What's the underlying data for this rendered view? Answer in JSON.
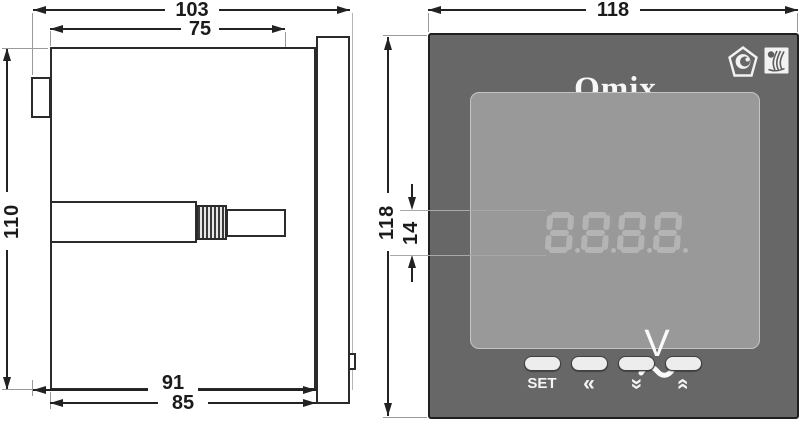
{
  "side_view": {
    "dims": {
      "overall_depth": "103",
      "case_depth": "75",
      "overall_height": "110",
      "depth_behind_panel": "91",
      "case_body_depth": "85"
    }
  },
  "front_view": {
    "dims": {
      "bezel_width": "118",
      "bezel_height": "118",
      "digit_height": "14"
    },
    "brand": "Omix",
    "display": {
      "value": "8.8.8.8",
      "style": "seven-segment"
    },
    "unit": {
      "symbol": "V",
      "modifier": "~"
    },
    "buttons": [
      {
        "name": "set",
        "label": "SET"
      },
      {
        "name": "left",
        "label": "«"
      },
      {
        "name": "down",
        "label": "«"
      },
      {
        "name": "up",
        "label": "«"
      }
    ],
    "logos": {
      "cert_mark": "pentagon-certification-mark",
      "maker_mark": "square-manufacturer-logo"
    },
    "colors": {
      "bezel": "#676767",
      "display_bg": "#999999",
      "digit": "#b4b4b4",
      "button": "#ededed",
      "text": "#f7f7f7"
    }
  }
}
